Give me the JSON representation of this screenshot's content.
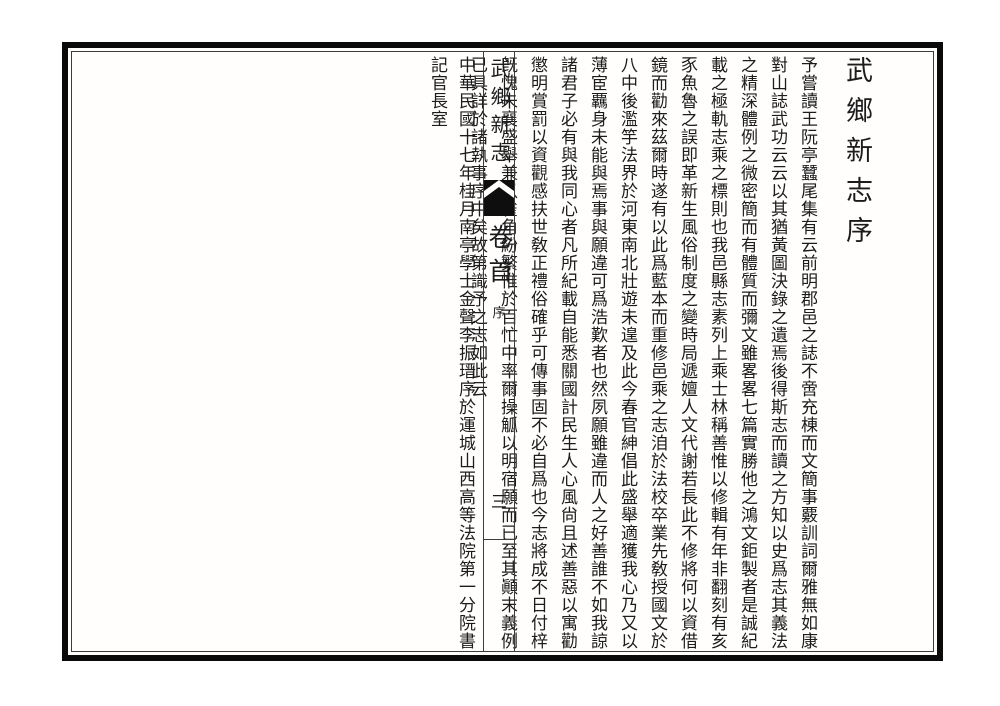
{
  "document": {
    "preface_title": "武鄉新志序",
    "body_columns": [
      "予嘗讀王阮亭蠶尾集有云前明郡邑之誌不啻充棟而文簡事覈訓詞爾雅無如康",
      "對山誌武功云云以其猶黃圖決錄之遺焉後得斯志而讀之方知以史爲志其義法",
      "之精深體例之微密簡而有體質而彌文雖畧畧七篇實勝他之鴻文鉅製者是誠紀",
      "載之極軌志乘之標則也我邑縣志素列上乘士林稱善惟以修輯有年非翻刻有亥",
      "豕魚魯之誤即革新生風俗制度之變時局遞嬗人文代謝若長此不修將何以資借",
      "鏡而勸來茲爾時遂有以此爲藍本而重修邑乘之志洎於法校卒業先敎授國文於",
      "八中後濫竽法界於河東南北壯遊未遑及此今春官紳倡此盛舉適獲我心乃又以",
      "薄宦覊身未能與焉事與願違可爲浩歎者也然夙願雖違而人之好善誰不如我諒",
      "諸君子必有與我同心者凡所紀載自能悉關國計民生人心風尙且述善惡以寓勸",
      "懲明賞罰以資觀感扶世敎正禮俗確乎可傳事固不必自爲也今志將成不日付梓",
      "旣愧未襄盛舉兼以雀角紛繁惟於百忙中率爾操觚以明宿願而已至其顚末義例",
      "已具詳於諸執事序中矣故第識予之志如此云"
    ],
    "fold": {
      "book_title": "武鄉新志",
      "fascicle": "卷首",
      "section_label": "序",
      "page_number": "三"
    },
    "colophon_columns": [
      "中華民國十七年桂月南亭學士金聲李振瑨序於運城山西高等法院第一分院書",
      "記官長室"
    ],
    "colors": {
      "ink": "#1c1c1c",
      "border": "#0a0a0a",
      "paper": "#fffefd"
    }
  }
}
